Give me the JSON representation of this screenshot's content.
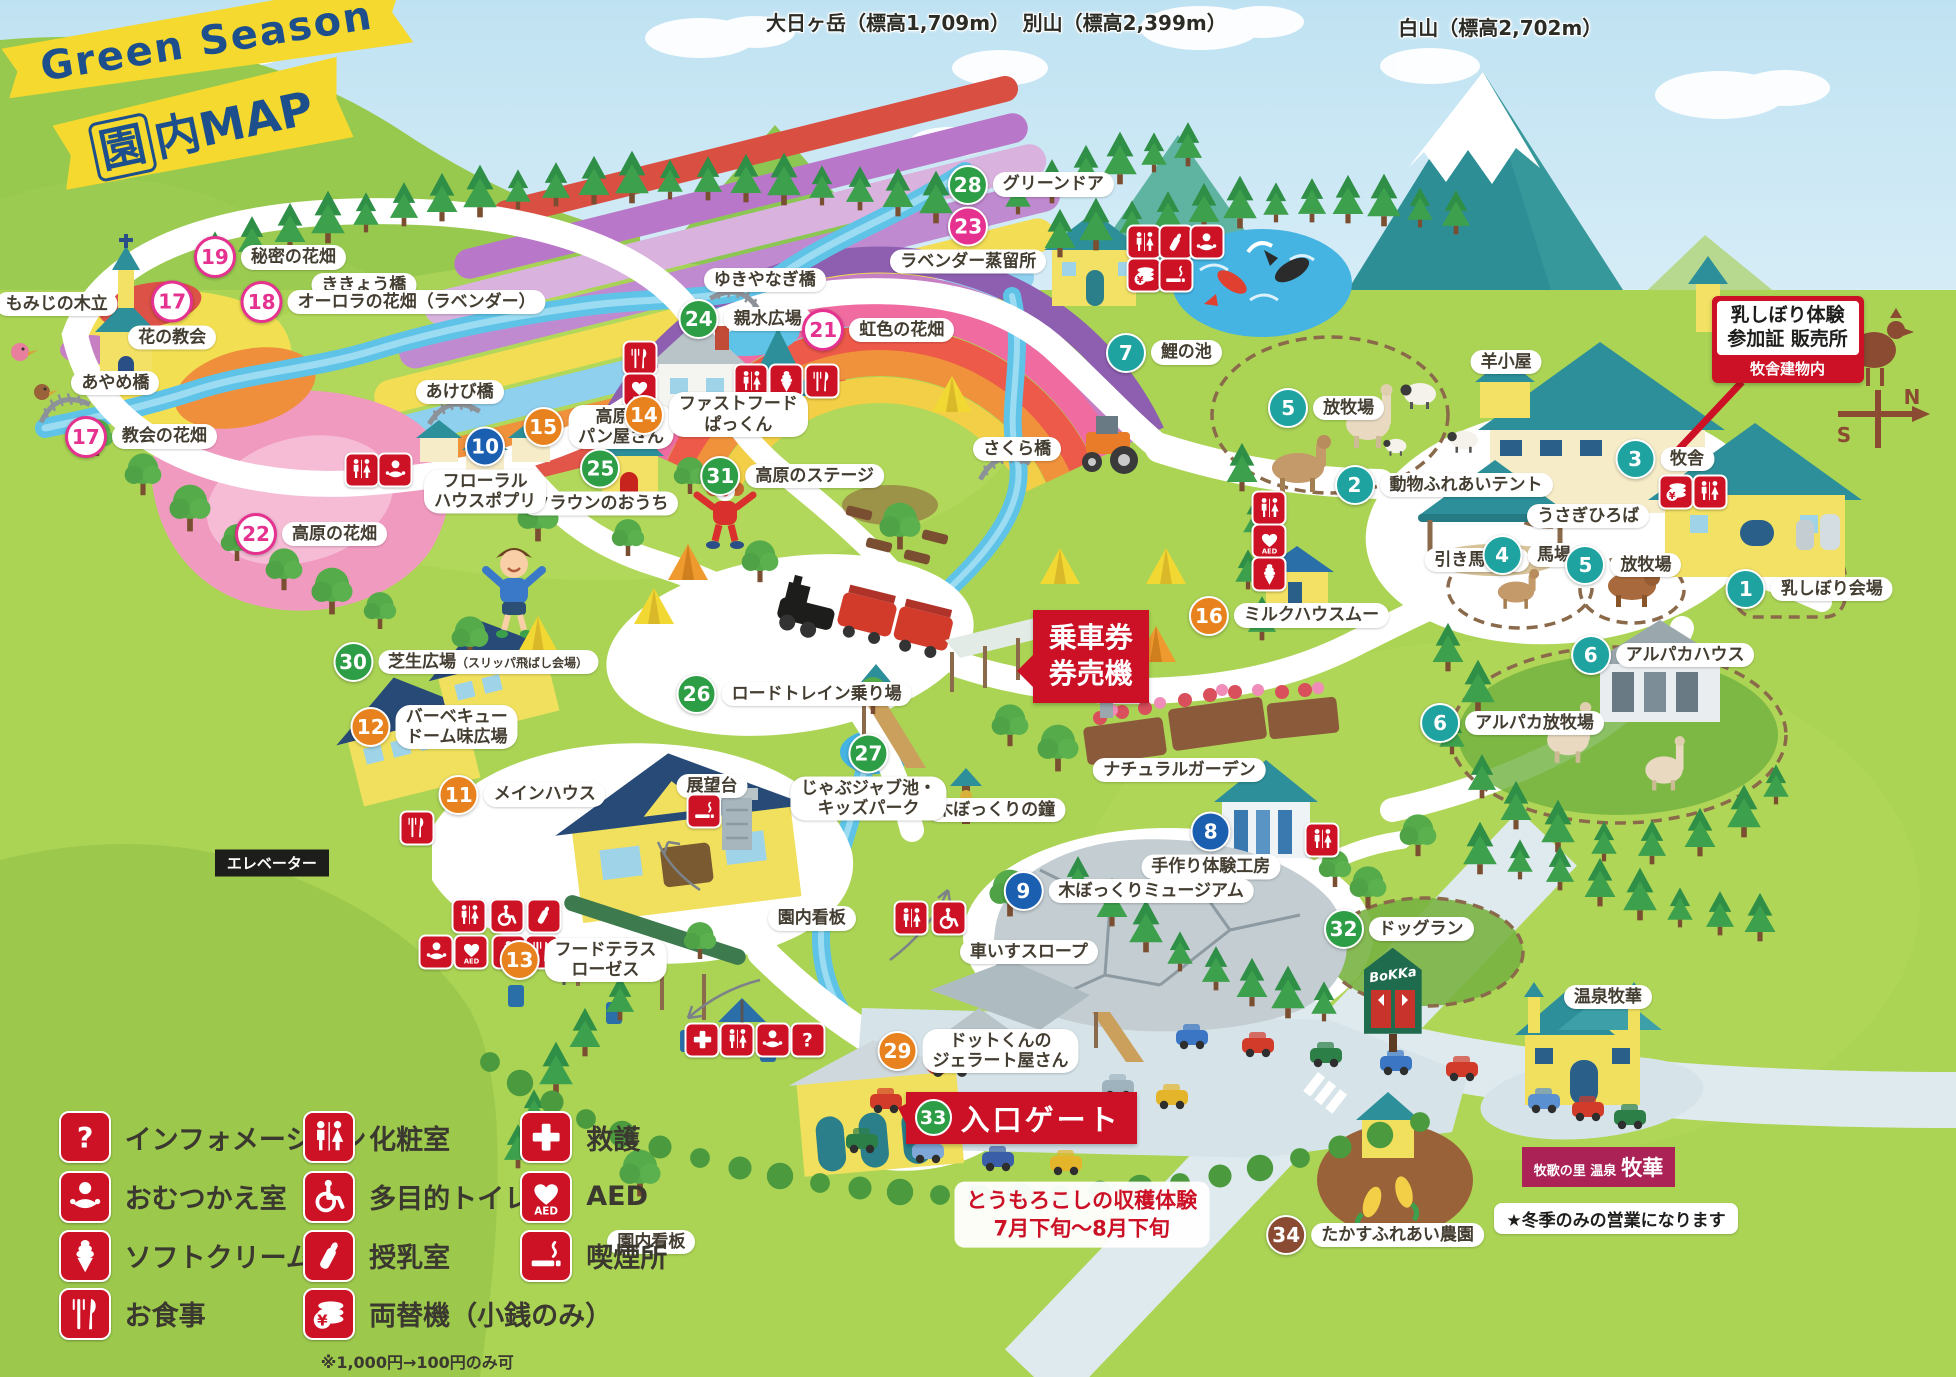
{
  "banner": {
    "line1": "Green Season",
    "line2_boxed": "園",
    "line2_rest": "内MAP"
  },
  "mountains": [
    {
      "label": "大日ヶ岳（標高1,709m）",
      "x": 45.4,
      "y": 0.5
    },
    {
      "label": "別山（標高2,399m）",
      "x": 57.5,
      "y": 0.5
    },
    {
      "label": "白山（標高2,702m）",
      "x": 76.7,
      "y": 0.9
    }
  ],
  "colors": {
    "teal": "#1fa3a0",
    "blue": "#1b5fb0",
    "orange": "#e8821e",
    "pink": "#e5318f",
    "green": "#2e9e46",
    "brown": "#8a4b32",
    "icon_red": "#cd1225",
    "sign_red": "#cc1126"
  },
  "pois": [
    {
      "num": "19",
      "color": "pink",
      "style": "outline",
      "x": 13.8,
      "y": 18.7,
      "lines": [
        "秘密の花畑"
      ],
      "pos": "right"
    },
    {
      "num": "18",
      "color": "pink",
      "style": "outline",
      "x": 20.1,
      "y": 21.9,
      "lines": [
        "オーロラの花畑（ラベンダー）"
      ],
      "pos": "right"
    },
    {
      "num": "20",
      "color": "pink",
      "style": "outline",
      "x": 1.7,
      "y": 22.1,
      "lines": [
        "もみじの木立"
      ],
      "pos": "right"
    },
    {
      "num": "17",
      "color": "pink",
      "style": "outline",
      "x": 8.8,
      "y": 22.9,
      "lines": [
        "花の教会"
      ],
      "pos": "below"
    },
    {
      "num": "17",
      "color": "pink",
      "style": "outline",
      "x": 7.2,
      "y": 31.7,
      "lines": [
        "教会の花畑"
      ],
      "pos": "right"
    },
    {
      "num": "24",
      "color": "green",
      "x": 38.1,
      "y": 23.2,
      "lines": [
        "親水広場"
      ],
      "pos": "right"
    },
    {
      "num": "21",
      "color": "pink",
      "style": "outline",
      "x": 44.9,
      "y": 24.0,
      "lines": [
        "虹色の花畑"
      ],
      "pos": "right"
    },
    {
      "num": "23",
      "color": "pink",
      "x": 49.5,
      "y": 17.4,
      "lines": [
        "ラベンダー蒸留所"
      ],
      "pos": "below"
    },
    {
      "num": "28",
      "color": "green",
      "x": 52.7,
      "y": 13.4,
      "lines": [
        "グリーンドア"
      ],
      "pos": "right"
    },
    {
      "num": "7",
      "color": "teal",
      "x": 59.5,
      "y": 25.6,
      "lines": [
        "鯉の池"
      ],
      "pos": "right"
    },
    {
      "num": "5",
      "color": "teal",
      "x": 67.8,
      "y": 29.6,
      "lines": [
        "放牧場"
      ],
      "pos": "right"
    },
    {
      "num": "2",
      "color": "teal",
      "x": 73.8,
      "y": 35.2,
      "lines": [
        "動物ふれあいテント"
      ],
      "pos": "right"
    },
    {
      "num": "3",
      "color": "teal",
      "x": 85.1,
      "y": 33.3,
      "lines": [
        "牧舎"
      ],
      "pos": "right"
    },
    {
      "num": "4",
      "color": "teal",
      "x": 78.3,
      "y": 40.3,
      "lines": [
        "馬場"
      ],
      "pos": "right"
    },
    {
      "num": "5",
      "color": "teal",
      "x": 83.0,
      "y": 41.0,
      "lines": [
        "放牧場"
      ],
      "pos": "right"
    },
    {
      "num": "1",
      "color": "teal",
      "x": 92.5,
      "y": 42.8,
      "lines": [
        "乳しぼり会場"
      ],
      "pos": "right"
    },
    {
      "num": "6",
      "color": "teal",
      "x": 85.0,
      "y": 47.6,
      "lines": [
        "アルパカハウス"
      ],
      "pos": "right"
    },
    {
      "num": "6",
      "color": "teal",
      "x": 77.3,
      "y": 52.5,
      "lines": [
        "アルパカ放牧場"
      ],
      "pos": "right"
    },
    {
      "num": "16",
      "color": "orange",
      "x": 65.9,
      "y": 44.7,
      "lines": [
        "ミルクハウスムー"
      ],
      "pos": "right"
    },
    {
      "num": "15",
      "color": "orange",
      "x": 30.6,
      "y": 31.0,
      "lines": [
        "高原の",
        "パン屋さん"
      ],
      "pos": "right"
    },
    {
      "num": "14",
      "color": "orange",
      "x": 36.6,
      "y": 30.1,
      "lines": [
        "ファストフード",
        "ぱっくん"
      ],
      "pos": "right"
    },
    {
      "num": "25",
      "color": "green",
      "x": 30.7,
      "y": 35.0,
      "lines": [
        "クラウンのおうち"
      ],
      "pos": "below"
    },
    {
      "num": "10",
      "color": "blue",
      "x": 24.8,
      "y": 34.1,
      "lines": [
        "フローラル",
        "ハウスポプリ"
      ],
      "pos": "below"
    },
    {
      "num": "31",
      "color": "green",
      "x": 40.5,
      "y": 34.6,
      "lines": [
        "高原のステージ"
      ],
      "pos": "right"
    },
    {
      "num": "22",
      "color": "pink",
      "style": "outline",
      "x": 15.9,
      "y": 38.8,
      "lines": [
        "高原の花畑"
      ],
      "pos": "right"
    },
    {
      "num": "30",
      "color": "green",
      "x": 23.8,
      "y": 48.1,
      "lines": [
        "芝生広場"
      ],
      "suffix": "（スリッパ飛ばし会場）",
      "pos": "right"
    },
    {
      "num": "26",
      "color": "green",
      "x": 40.6,
      "y": 50.4,
      "lines": [
        "ロードトレイン乗り場"
      ],
      "pos": "right"
    },
    {
      "num": "12",
      "color": "orange",
      "x": 22.2,
      "y": 52.8,
      "lines": [
        "バーベキュー",
        "ドーム味広場"
      ],
      "pos": "right"
    },
    {
      "num": "11",
      "color": "orange",
      "x": 26.7,
      "y": 57.7,
      "lines": [
        "メインハウス"
      ],
      "pos": "right"
    },
    {
      "num": "27",
      "color": "green",
      "x": 44.4,
      "y": 56.4,
      "lines": [
        "じゃぶジャブ池・",
        "キッズパーク"
      ],
      "pos": "below"
    },
    {
      "num": "8",
      "color": "blue",
      "x": 61.9,
      "y": 61.4,
      "lines": [
        "手作り体験工房"
      ],
      "pos": "below"
    },
    {
      "num": "9",
      "color": "blue",
      "x": 57.7,
      "y": 64.7,
      "lines": [
        "木ぼっくりミュージアム"
      ],
      "pos": "right"
    },
    {
      "num": "32",
      "color": "green",
      "x": 71.5,
      "y": 67.5,
      "lines": [
        "ドッグラン"
      ],
      "pos": "right"
    },
    {
      "num": "13",
      "color": "orange",
      "x": 29.8,
      "y": 69.7,
      "lines": [
        "フードテラス",
        "ローゼス"
      ],
      "pos": "right"
    },
    {
      "num": "29",
      "color": "orange",
      "x": 50.0,
      "y": 76.3,
      "lines": [
        "ドットくんの",
        "ジェラート屋さん"
      ],
      "pos": "right"
    },
    {
      "num": "34",
      "color": "brown",
      "x": 70.3,
      "y": 89.7,
      "lines": [
        "たかすふれあい農園"
      ],
      "pos": "right"
    }
  ],
  "plain_labels": [
    {
      "text": "ききょう橋",
      "x": 18.6,
      "y": 20.7,
      "style": "pill"
    },
    {
      "text": "あけび橋",
      "x": 23.5,
      "y": 28.5,
      "style": "pill"
    },
    {
      "text": "あやめ橋",
      "x": 5.9,
      "y": 27.8,
      "style": "pill"
    },
    {
      "text": "ゆきやなぎ橋",
      "x": 39.1,
      "y": 20.3,
      "style": "pill"
    },
    {
      "text": "さくら橋",
      "x": 52.0,
      "y": 32.6,
      "style": "pill"
    },
    {
      "text": "羊小屋",
      "x": 77.0,
      "y": 26.3,
      "style": "pill"
    },
    {
      "text": "うさぎひろば",
      "x": 81.2,
      "y": 37.5,
      "style": "pill"
    },
    {
      "text": "引き馬受付",
      "x": 75.5,
      "y": 40.7,
      "style": "pill"
    },
    {
      "text": "展望台",
      "x": 36.4,
      "y": 57.1,
      "style": "pill"
    },
    {
      "text": "園内看板",
      "x": 41.5,
      "y": 66.7,
      "style": "pill"
    },
    {
      "text": "園内看板",
      "x": 33.3,
      "y": 90.2,
      "style": "pill"
    },
    {
      "text": "ナチュラルガーデン",
      "x": 60.3,
      "y": 55.9,
      "style": "pill"
    },
    {
      "text": "木ぼっくりの鐘",
      "x": 50.9,
      "y": 58.8,
      "style": "pill"
    },
    {
      "text": "車いすスロープ",
      "x": 52.6,
      "y": 69.1,
      "style": "pill"
    },
    {
      "text": "温泉牧華",
      "x": 82.2,
      "y": 72.4,
      "style": "pill"
    },
    {
      "text": "エレベーター",
      "x": 13.9,
      "y": 62.7,
      "style": "black"
    }
  ],
  "icon_badges": [
    {
      "icon": "restroom",
      "x": 58.5,
      "y": 17.6
    },
    {
      "icon": "bottle",
      "x": 60.1,
      "y": 17.6
    },
    {
      "icon": "baby",
      "x": 61.7,
      "y": 17.6
    },
    {
      "icon": "coins",
      "x": 58.5,
      "y": 20.0
    },
    {
      "icon": "smoking",
      "x": 60.1,
      "y": 20.0
    },
    {
      "icon": "food",
      "x": 32.7,
      "y": 26.0
    },
    {
      "icon": "aed",
      "x": 32.7,
      "y": 28.3
    },
    {
      "icon": "restroom",
      "x": 38.4,
      "y": 27.7
    },
    {
      "icon": "softserve",
      "x": 40.2,
      "y": 27.7
    },
    {
      "icon": "food",
      "x": 42.0,
      "y": 27.7
    },
    {
      "icon": "restroom",
      "x": 18.5,
      "y": 34.1
    },
    {
      "icon": "baby",
      "x": 20.2,
      "y": 34.1
    },
    {
      "icon": "restroom",
      "x": 64.9,
      "y": 36.9
    },
    {
      "icon": "aed",
      "x": 64.9,
      "y": 39.3
    },
    {
      "icon": "softserve",
      "x": 64.9,
      "y": 41.7
    },
    {
      "icon": "coins",
      "x": 85.7,
      "y": 35.7
    },
    {
      "icon": "restroom",
      "x": 87.4,
      "y": 35.7
    },
    {
      "icon": "restroom",
      "x": 24.0,
      "y": 66.5
    },
    {
      "icon": "wheelchair",
      "x": 25.9,
      "y": 66.5
    },
    {
      "icon": "bottle",
      "x": 27.8,
      "y": 66.5
    },
    {
      "icon": "baby",
      "x": 22.3,
      "y": 69.1
    },
    {
      "icon": "aed",
      "x": 24.1,
      "y": 69.1
    },
    {
      "icon": "softserve",
      "x": 26.0,
      "y": 69.1
    },
    {
      "icon": "food",
      "x": 27.7,
      "y": 69.1
    },
    {
      "icon": "food",
      "x": 21.3,
      "y": 60.1
    },
    {
      "icon": "smoking",
      "x": 36.0,
      "y": 58.9
    },
    {
      "icon": "restroom",
      "x": 67.6,
      "y": 61.0
    },
    {
      "icon": "restroom",
      "x": 46.6,
      "y": 66.7
    },
    {
      "icon": "wheelchair",
      "x": 48.5,
      "y": 66.7
    },
    {
      "icon": "cross",
      "x": 35.9,
      "y": 75.5
    },
    {
      "icon": "restroom",
      "x": 37.7,
      "y": 75.5
    },
    {
      "icon": "baby",
      "x": 39.5,
      "y": 75.5
    },
    {
      "icon": "question",
      "x": 41.3,
      "y": 75.5
    }
  ],
  "legend": {
    "items": [
      {
        "icon": "question",
        "label": "インフォメーション",
        "x": 3.0,
        "y": 82.6
      },
      {
        "icon": "baby",
        "label": "おむつかえ室",
        "x": 3.0,
        "y": 86.9
      },
      {
        "icon": "softserve",
        "label": "ソフトクリーム",
        "x": 3.0,
        "y": 91.2
      },
      {
        "icon": "food",
        "label": "お食事",
        "x": 3.0,
        "y": 95.4
      },
      {
        "icon": "restroom",
        "label": "化粧室",
        "x": 15.5,
        "y": 82.6
      },
      {
        "icon": "wheelchair",
        "label": "多目的トイレ",
        "x": 15.5,
        "y": 86.9
      },
      {
        "icon": "bottle",
        "label": "授乳室",
        "x": 15.5,
        "y": 91.2
      },
      {
        "icon": "coins",
        "label": "両替機（小銭のみ）",
        "x": 15.5,
        "y": 95.4
      },
      {
        "icon": "cross",
        "label": "救護",
        "x": 26.6,
        "y": 82.6
      },
      {
        "icon": "aed",
        "label": "AED",
        "x": 26.6,
        "y": 86.9
      },
      {
        "icon": "smoking",
        "label": "喫煙所",
        "x": 26.6,
        "y": 91.2
      }
    ],
    "note": {
      "text": "※1,000円→100円のみ可",
      "x": 16.4,
      "y": 98.0
    }
  },
  "signs": {
    "milking": {
      "line1": "乳しぼり体験",
      "line2": "参加証 販売所",
      "line3": "牧舎建物内"
    },
    "ticket": {
      "line1": "乗車券",
      "line2": "券売機"
    },
    "entrance": {
      "num": "33",
      "label": "入口ゲート"
    },
    "corn": {
      "line1": "とうもろこしの収穫体験",
      "line2": "7月下旬～8月下旬"
    },
    "onsen_logo": {
      "small": "牧歌の里 温泉",
      "big": "牧華"
    },
    "winter_note": {
      "text": "★冬季のみの営業になります"
    }
  },
  "bokka_sign": {
    "text": "BoKKa"
  },
  "weathervane": {
    "s": "S",
    "n": "N"
  }
}
